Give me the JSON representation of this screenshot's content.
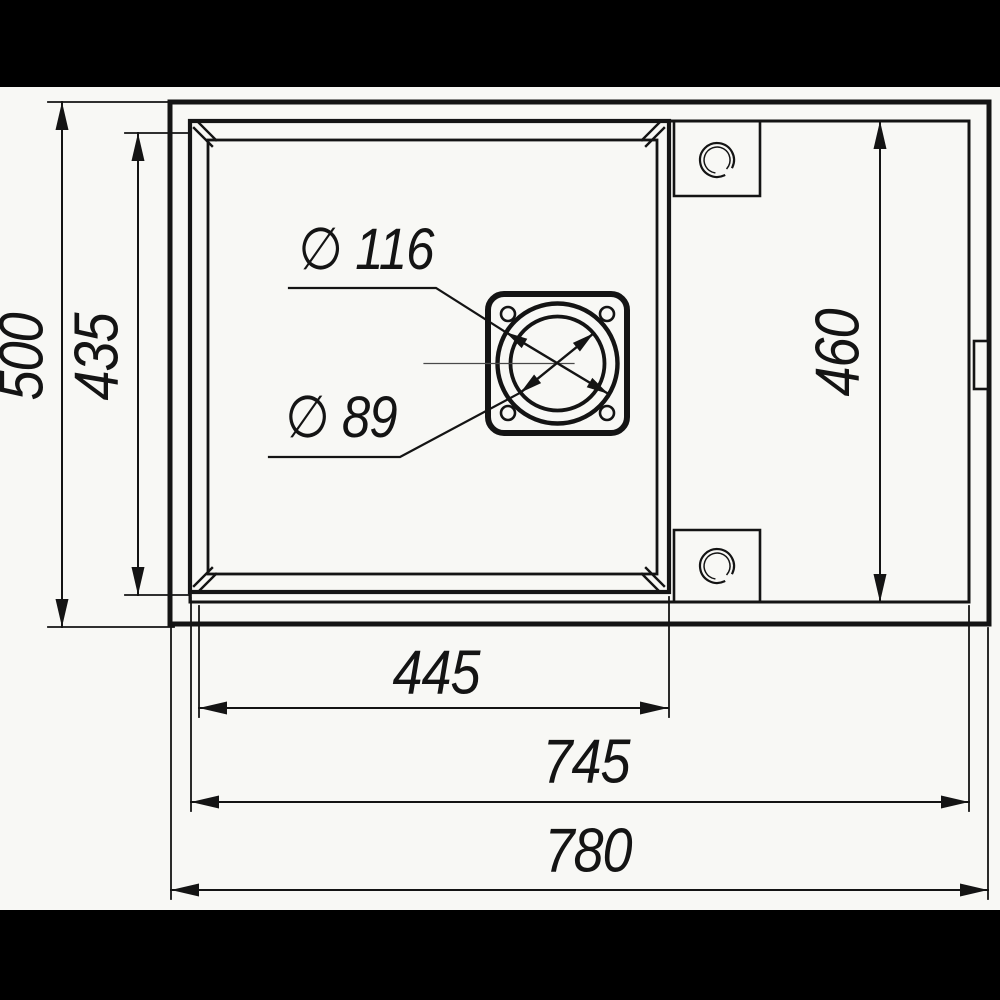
{
  "dims": {
    "overall_height": "500",
    "bowl_height": "435",
    "inner_height_right": "460",
    "bowl_width": "445",
    "inner_width": "745",
    "overall_width": "780"
  },
  "callouts": {
    "drain_outer_diameter": "∅ 116",
    "drain_inner_diameter": "∅ 89"
  },
  "colors": {
    "line": "#141414",
    "background": "#f8f8f5",
    "bars": "#000000"
  }
}
